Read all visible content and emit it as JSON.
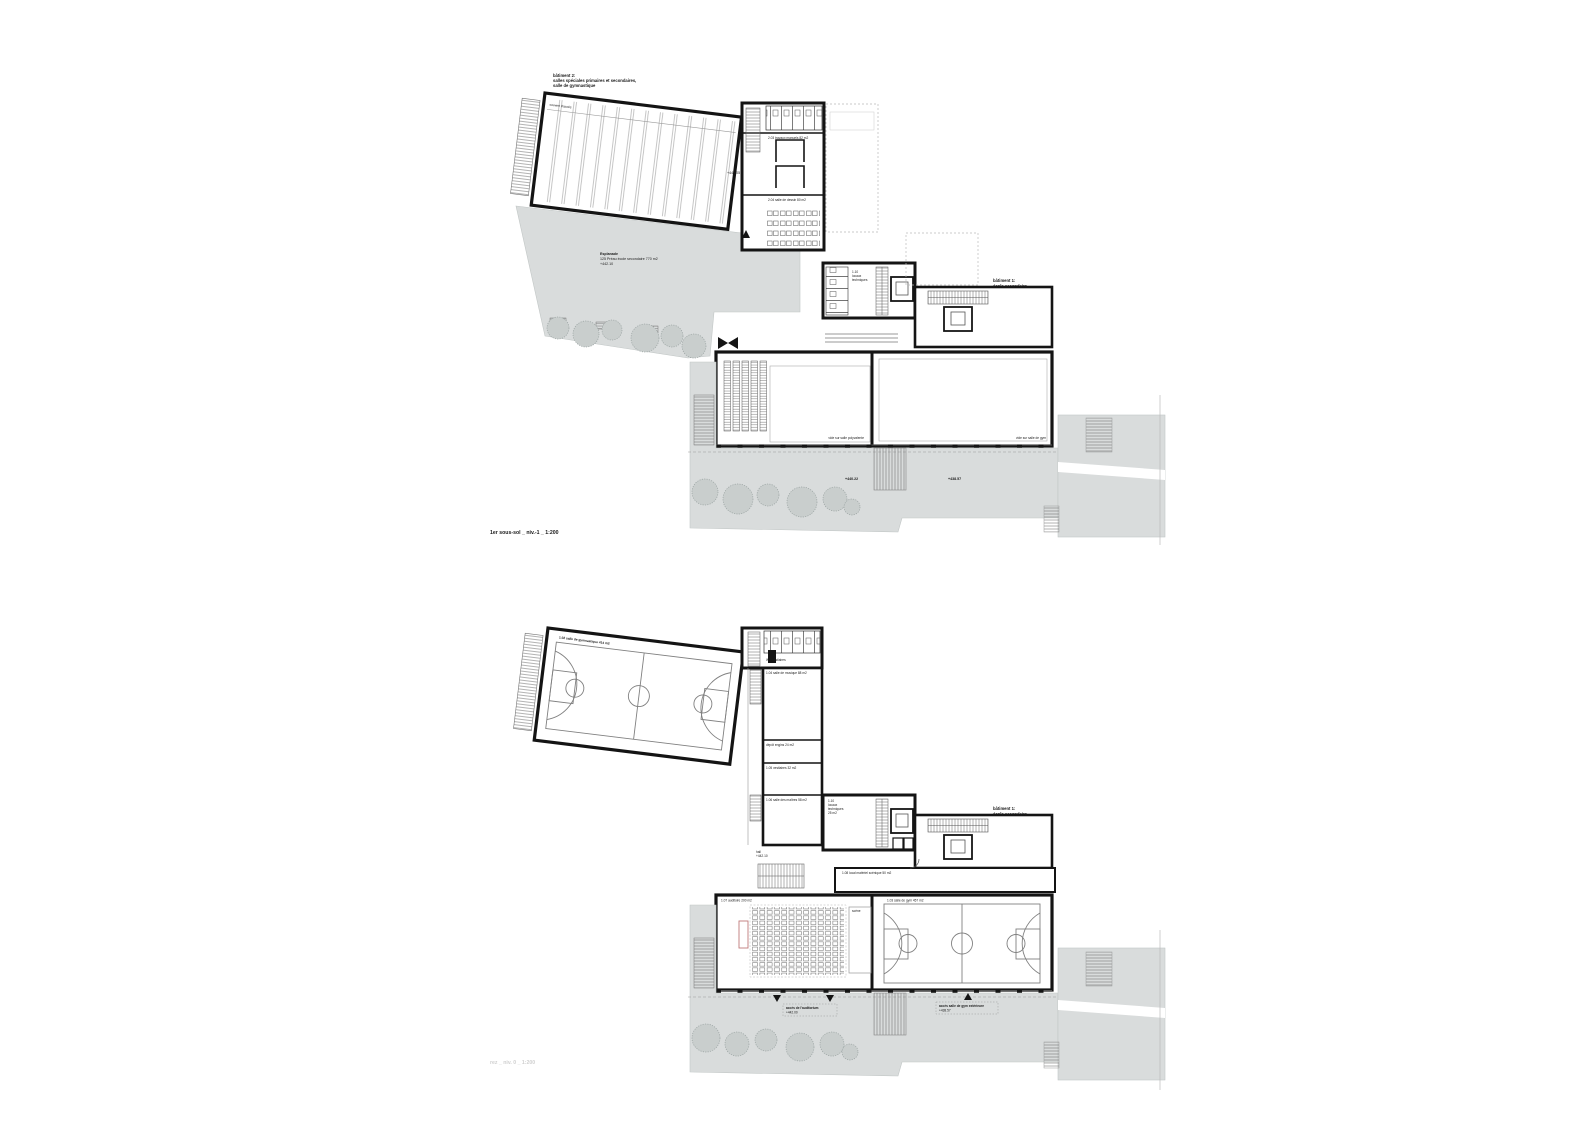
{
  "colors": {
    "wall": "#141414",
    "paving": "#d9dcdc",
    "tree": "#c9cecd",
    "court_line": "#808080",
    "stage_outline": "#c07a7a",
    "faint_text": "#d0d0d0"
  },
  "shared": {
    "building1": [
      "bâtiment 1:",
      "école secondaire"
    ]
  },
  "plan_upper": {
    "title": "1er sous-sol _ niv.-1 _ 1:200",
    "building2": [
      "bâtiment 2:",
      "salles spéciales primaires et secondaires,",
      "salle de gymnastique"
    ],
    "hall_note": "couvert d'accès",
    "hall_level": "+441.05",
    "esplanade": [
      "Esplanade",
      "125 Préau école secondaire 770 m2",
      "+442.10"
    ],
    "room_labels": [
      "2.03 travaux manuels 82 m2",
      "2.04 salle de dessin 80 m2"
    ],
    "tech_block": [
      "1.10",
      "locaux",
      "techniques"
    ],
    "hall_void_left": "vide sur salle polyvalente",
    "hall_void_right": "vide sur salle de gym",
    "terrace_levels": [
      "+440.22",
      "+438.57"
    ]
  },
  "plan_lower": {
    "title": "rez _ niv. 0 _ 1:200",
    "gym_hall_label": "1.02 salle de gymnastique 414 m2",
    "wc_label": "WC vestiaires",
    "wing_rooms": [
      "1.04 salle de musique 88 m2",
      "dépôt engins 24 m2",
      "1.05 vestiaires 32 m2",
      "1.06 salle des maîtres 58 m2"
    ],
    "hall_entry": [
      "hall",
      "+442.10"
    ],
    "tech_block": [
      "1.10",
      "locaux",
      "techniques",
      "25 m2"
    ],
    "stage_store": "1.08 local matériel scénique 50 m2",
    "auditorium_label": "1.07 auditoire 200 m2",
    "scene_label": "scène",
    "gym_label": "1.03 salle de gym 457 m2",
    "access_left": [
      "accès de l'auditorium",
      "+442.00"
    ],
    "access_right": [
      "accès salle de gym extérieure",
      "+438.57"
    ]
  }
}
